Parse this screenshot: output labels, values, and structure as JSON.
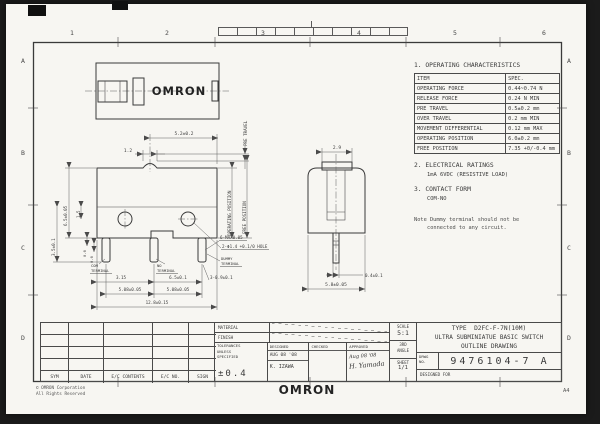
{
  "zones": {
    "cols": [
      "1",
      "2",
      "3",
      "4",
      "5",
      "6"
    ],
    "rows": [
      "A",
      "B",
      "C",
      "D"
    ]
  },
  "characteristics": {
    "title": "1. OPERATING CHARACTERISTICS",
    "headers": [
      "ITEM",
      "SPEC."
    ],
    "rows": [
      [
        "OPERATING FORCE",
        "0.44~0.74 N"
      ],
      [
        "RELEASE FORCE",
        "0.24 N MIN"
      ],
      [
        "PRE TRAVEL",
        "0.5±0.2 mm"
      ],
      [
        "OVER TRAVEL",
        "0.2 mm MIN"
      ],
      [
        "MOVEMENT DIFFERENTIAL",
        "0.12 mm MAX"
      ],
      [
        "OPERATING POSITION",
        "6.0±0.2 mm"
      ],
      [
        "FREE POSITION",
        "7.35 +0/-0.4 mm"
      ]
    ]
  },
  "electrical": {
    "title": "2. ELECTRICAL RATINGS",
    "value": "1mA 6VDC (RESISTIVE LOAD)"
  },
  "contact": {
    "title": "3. CONTACT FORM",
    "value": "COM-NO"
  },
  "note": {
    "line1": "Note Dummy terminal should not be",
    "line2": "connected to any circuit."
  },
  "top_view": {
    "logo": "OMRON"
  },
  "front_view": {
    "dim_button_width": "1.2",
    "dim_button_pos": "5.2±0.2",
    "label_pre_travel": "PRE TRAVEL",
    "label_operating_position": "OPERATING POSITION",
    "label_free_position": "FREE POSITION",
    "dim_height": "6.5±0.05",
    "dim_step": "1.5",
    "dim_terminal_length": "3.5±0.1",
    "dim_t1": "0.6",
    "dim_t2": "0.6",
    "note_burr": "6-MAX0.05",
    "note_hole": "2-Φ1.4 +0.1/0 HOLE",
    "label_com_1": "COM",
    "label_com_2": "TERMINAL",
    "label_no_1": "NO",
    "label_no_2": "TERMINAL",
    "label_dummy_1": "DUMMY",
    "label_dummy_2": "TERMINAL",
    "dim_com": "3.15",
    "dim_no": "6.5±0.1",
    "dim_term_width": "3-0.9±0.1",
    "dim_pitch_1": "5.08±0.05",
    "dim_pitch_2": "5.08±0.05",
    "dim_overall": "12.8±0.15"
  },
  "side_view": {
    "dim_button_width": "2.9",
    "dim_terminal": "0.4±0.1",
    "dim_depth": "5.8±0.05"
  },
  "revision_table": {
    "headers": [
      "SYM",
      "DATE",
      "E/C CONTENTS",
      "E/C NO.",
      "SIGN"
    ]
  },
  "title_block": {
    "material_label": "MATERIAL",
    "finish_label": "FINISH",
    "tol_label1": "TOLERANCES",
    "tol_label2": "UNLESS",
    "tol_label3": "SPECIFIED",
    "tol_value": "±0.4",
    "designed_label": "DESIGNED",
    "designed_date": "AUG 08 '08",
    "designed_name": "K. IZAWA",
    "checked_label": "CHECKED",
    "approved_label": "APPROVED",
    "approved_date": "Aug 08 '08",
    "approved_sign": "H. Yamada",
    "scale_label": "SCALE",
    "scale_value": "5:1",
    "angle_line1": "3RD",
    "angle_line2": "ANGLE",
    "sheet_label": "SHEET",
    "sheet_value": "1/1",
    "type_line1": "TYPE  D2FC-F-7N(10M)",
    "type_line2": "ULTRA SUBMINIATUE BASIC SWITCH",
    "type_line3": "OUTLINE DRAWING",
    "drwg_label1": "DRWG",
    "drwg_label2": "NO.",
    "drwg_no": "9476104-7 A",
    "designed_for": "DESIGNED FOR"
  },
  "footer": {
    "logo": "OMRON",
    "copyright_line1": "© OMRON Corporation",
    "copyright_line2": "All Rights Reserved",
    "sheet_size": "A4"
  }
}
